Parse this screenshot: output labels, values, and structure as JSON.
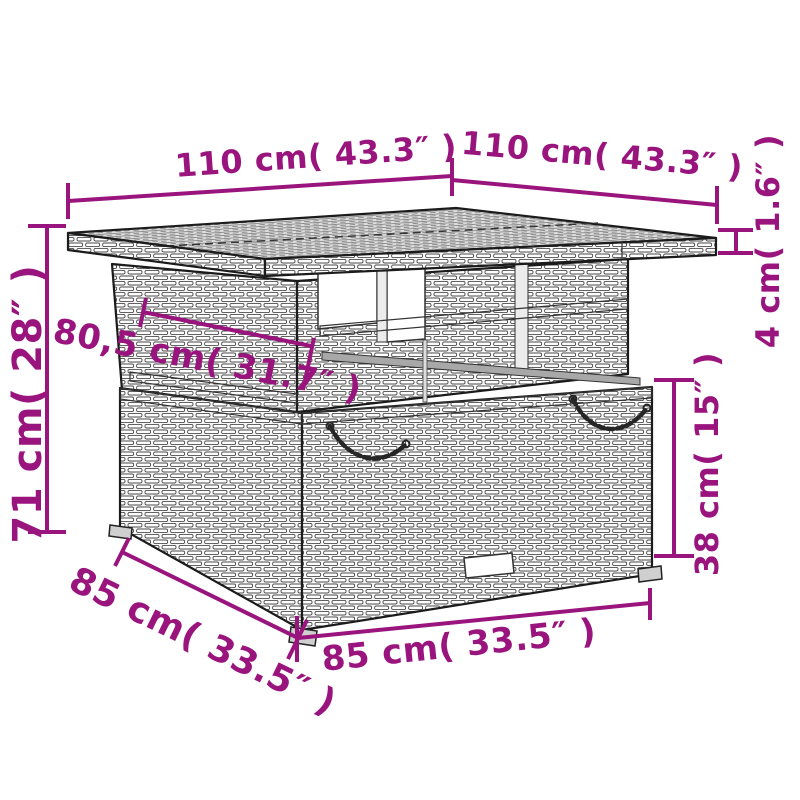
{
  "accent_color": "#9A147E",
  "line_color": "#1B1B1B",
  "dimensions": {
    "tabletop_width": "110 cm( 43.3″ )",
    "tabletop_depth": "110 cm( 43.3″ )",
    "tabletop_thickness": "4 cm( 1.6″ )",
    "total_height": "71 cm( 28″ )",
    "shelf_width": "80,5 cm( 31.7″ )",
    "base_height": "38 cm( 15″ )",
    "base_depth": "85 cm( 33.5″ )",
    "base_width": "85 cm( 33.5″ )"
  }
}
